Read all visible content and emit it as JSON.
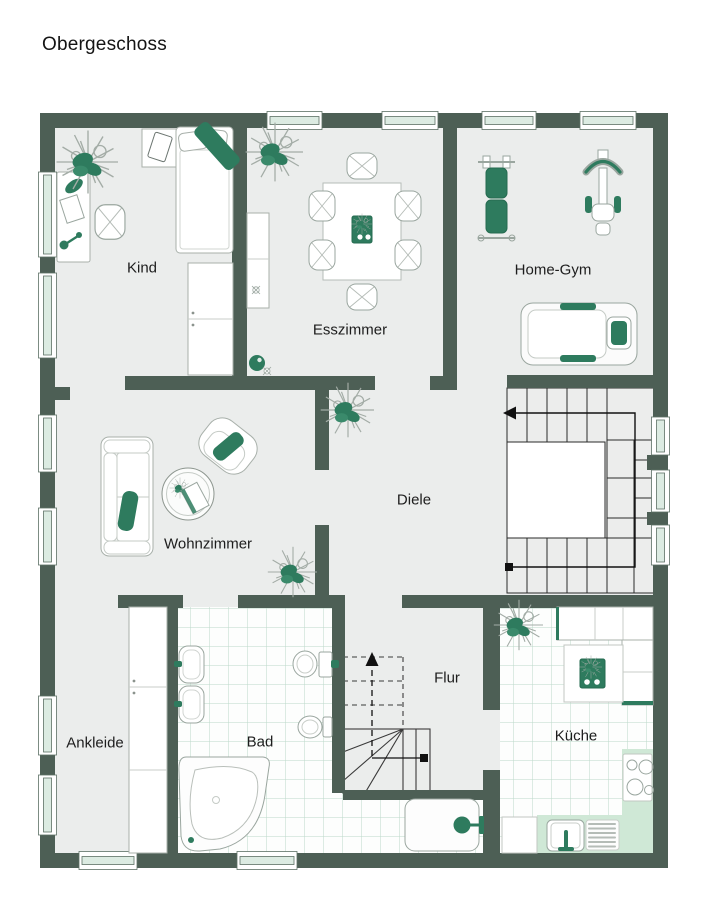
{
  "title": "Obergeschoss",
  "floor_plan": {
    "level": "upper floor",
    "colors": {
      "wall": "#4d5f55",
      "floor": "#ebedec",
      "accent_green": "#2e7b5e",
      "tile_line": "#bcd8c9",
      "counter_green": "#cfe8d6",
      "background": "#ffffff"
    },
    "window_counts": {
      "left_wall": 6,
      "top_wall": 4,
      "right_wall": 3,
      "bottom_wall": 2
    }
  },
  "rooms": {
    "kind": {
      "label": "Kind",
      "furniture": [
        "bed",
        "wardrobe",
        "desk",
        "desk-chair",
        "side-table-with-tablet",
        "plant"
      ]
    },
    "esszimmer": {
      "label": "Esszimmer",
      "furniture": [
        "dining-table",
        "six-chairs",
        "sideboard",
        "plant",
        "decor"
      ]
    },
    "homegym": {
      "label": "Home-Gym",
      "furniture": [
        "weight-bench",
        "exercise-machine",
        "treadmill"
      ]
    },
    "diele": {
      "label": "Diele",
      "furniture": [
        "plant",
        "plant",
        "main-staircase-up"
      ]
    },
    "wohnzimmer": {
      "label": "Wohnzimmer",
      "furniture": [
        "sofa",
        "armchair",
        "round-coffee-table"
      ]
    },
    "ankleide": {
      "label": "Ankleide",
      "furniture": [
        "closet-column"
      ]
    },
    "bad": {
      "label": "Bad",
      "furniture": [
        "two-washbasins",
        "toilet",
        "bidet",
        "corner-bathtub",
        "shower"
      ]
    },
    "flur": {
      "label": "Flur",
      "furniture": [
        "staircase-down"
      ]
    },
    "kueche": {
      "label": "Küche",
      "furniture": [
        "island-with-hob",
        "counters",
        "stove",
        "sink",
        "plant"
      ]
    }
  },
  "stairs": {
    "main_staircase": {
      "shape": "U",
      "walkline_arrow": "left-up"
    },
    "flur_staircase": {
      "shape": "winder",
      "walkline_arrow": "up"
    }
  }
}
